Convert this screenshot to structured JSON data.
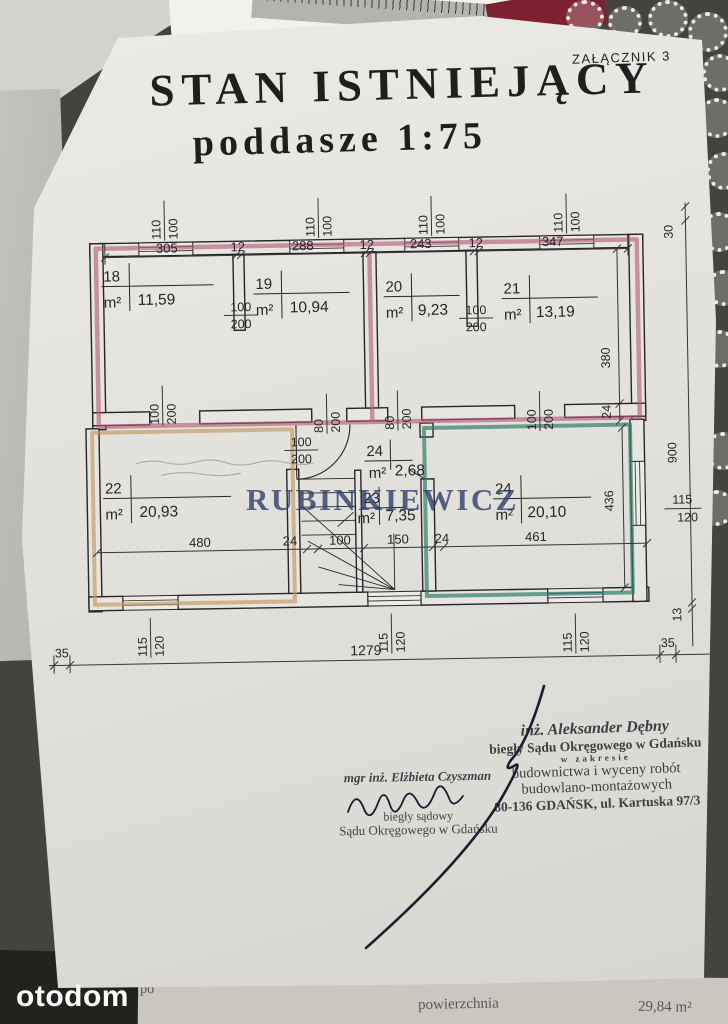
{
  "page": {
    "attachment_label": "ZAŁĄCZNIK 3",
    "title_line1": "STAN ISTNIEJĄCY",
    "title_line2": "poddasze 1:75",
    "watermark": "RUBINKIEWICZ",
    "portal_logo": "otodom",
    "underlay": {
      "frag1": "po",
      "frag2": "powierzchnia",
      "frag3": "29,84 m²"
    }
  },
  "plan": {
    "unit": "m²",
    "rooms": [
      {
        "number": "18",
        "area": "11,59"
      },
      {
        "number": "19",
        "area": "10,94"
      },
      {
        "number": "20",
        "area": "9,23"
      },
      {
        "number": "21",
        "area": "13,19"
      },
      {
        "number": "22",
        "area": "20,93"
      },
      {
        "number": "23",
        "area": "7,35"
      },
      {
        "number": "24",
        "area": "2,68"
      },
      {
        "number": "24",
        "area": "20,10"
      }
    ],
    "dims": {
      "top": [
        "305",
        "12",
        "288",
        "12",
        "243",
        "12",
        "347"
      ],
      "inner_bottom": [
        "480",
        "24",
        "100",
        "150",
        "24",
        "461"
      ],
      "outer_bottom": {
        "left": "35",
        "total": "1279",
        "right": "35"
      },
      "right": {
        "r30": "30",
        "r380": "380",
        "r24": "24",
        "r900": "900",
        "r436": "436",
        "r13": "13"
      },
      "fr": {
        "win_top_w": "110",
        "win_top_h": "100",
        "door100_w": "100",
        "door100_h": "200",
        "door80_w": "80",
        "door80_h": "200",
        "win_bottom_w": "115",
        "win_bottom_h": "120",
        "win_right_w": "115",
        "win_right_h": "120"
      }
    },
    "colors": {
      "band_pink": "#b55a78",
      "room22_tan": "#bf9a62",
      "room24_teal": "#2e7f6c",
      "ink": "#26262a"
    }
  },
  "stamps": {
    "right": {
      "line1": "inż. Aleksander Dębny",
      "line2": "biegły Sądu Okręgowego w Gdańsku",
      "line3": "w zakresie",
      "line4": "budownictwa i wyceny robót",
      "line5": "budowlano-montażowych",
      "line6": "80-136 GDAŃSK, ul. Kartuska 97/3"
    },
    "left": {
      "line1": "mgr inż. Elżbieta Czyszman",
      "line2": "biegły sądowy",
      "line3": "Sądu Okręgowego w Gdańsku"
    }
  }
}
